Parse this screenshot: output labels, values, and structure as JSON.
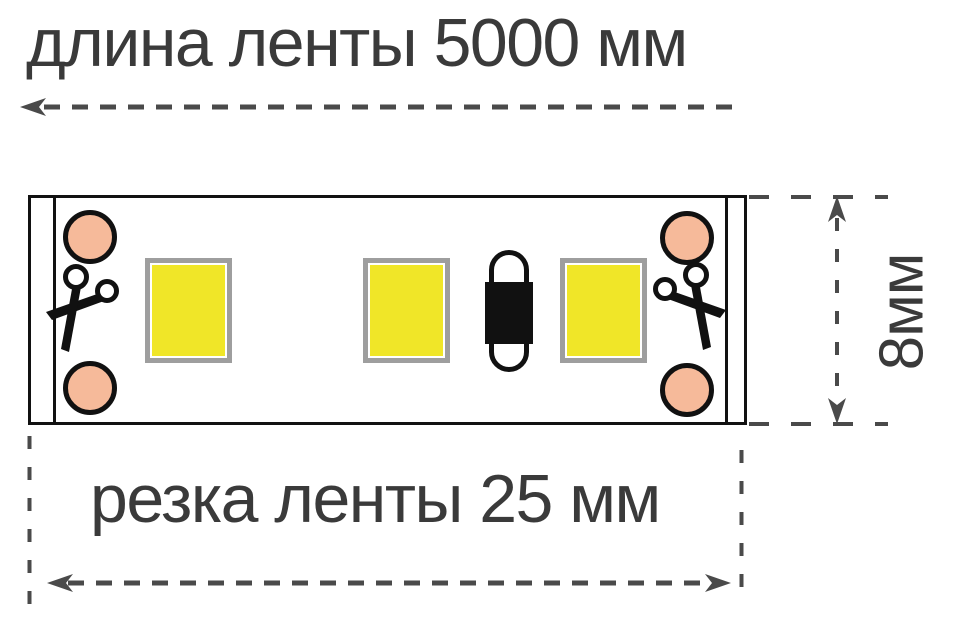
{
  "diagram": {
    "top_dimension": {
      "label": "длина ленты 5000 мм"
    },
    "bottom_dimension": {
      "label": "резка ленты 25 мм"
    },
    "side_dimension": {
      "label": "8мм"
    }
  },
  "colors": {
    "line": "#4a4a4a",
    "text": "#3a3a3a",
    "outline": "#111111",
    "pad": "#f6ba9a",
    "led": "#f0e628",
    "led-border": "#9e9e9e"
  }
}
